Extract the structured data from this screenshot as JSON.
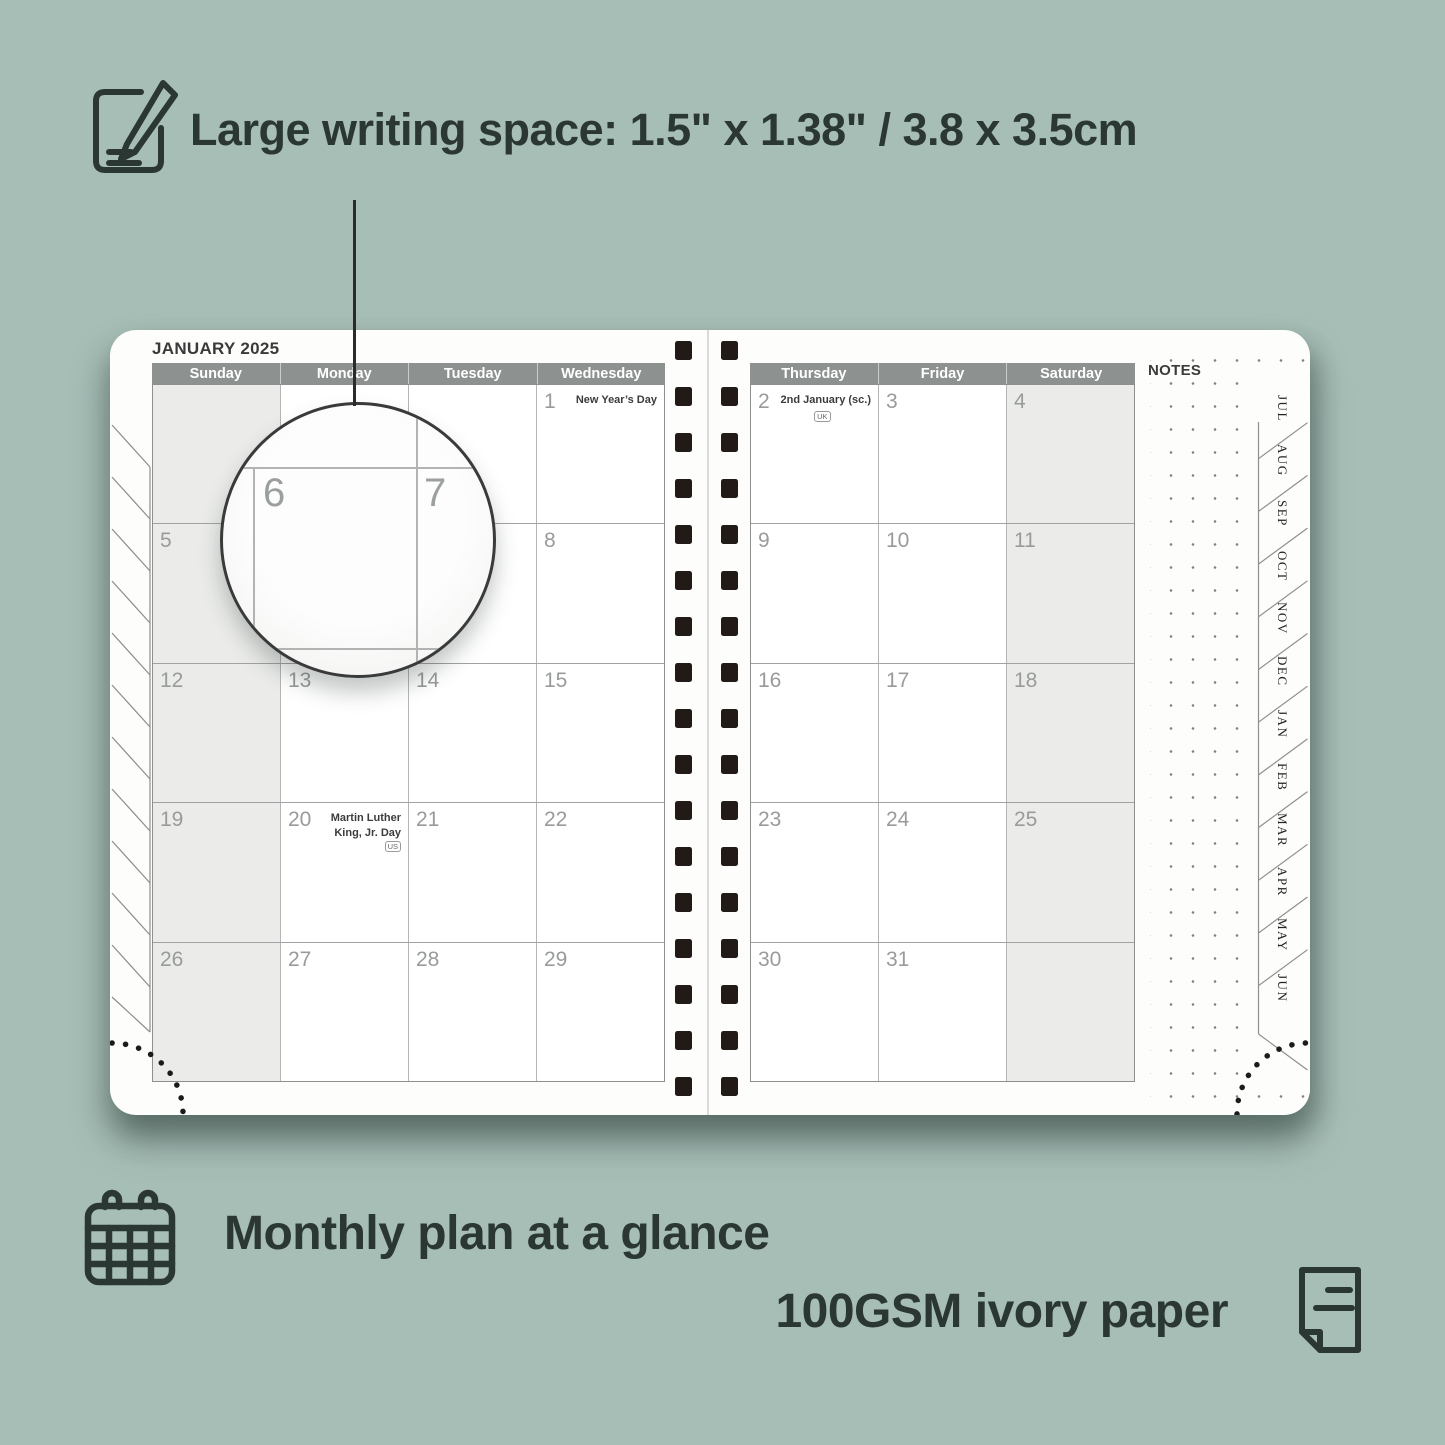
{
  "colors": {
    "background": "#a7beb7",
    "feature_text": "#2b3732",
    "day_header_bg": "#8d918f",
    "shaded_cell": "#ebecea",
    "spiral": "#221a17"
  },
  "features": {
    "writing_space": "Large writing space: 1.5\" x 1.38\" / 3.8 x 3.5cm",
    "monthly_plan": "Monthly plan at a glance",
    "paper": "100GSM ivory paper"
  },
  "planner": {
    "title": "JANUARY 2025",
    "notes_label": "NOTES",
    "left_day_headers": [
      "Sunday",
      "Monday",
      "Tuesday",
      "Wednesday"
    ],
    "right_day_headers": [
      "Thursday",
      "Friday",
      "Saturday"
    ],
    "month_tabs": [
      "JUL",
      "AUG",
      "SEP",
      "OCT",
      "NOV",
      "DEC",
      "JAN",
      "FEB",
      "MAR",
      "APR",
      "MAY",
      "JUN"
    ],
    "shaded_columns": {
      "left": [
        0
      ],
      "right": [
        2
      ]
    },
    "left_grid": [
      [
        {
          "date": ""
        },
        {
          "date": ""
        },
        {
          "date": ""
        },
        {
          "date": "1",
          "holiday": "New Year’s Day"
        }
      ],
      [
        {
          "date": "5"
        },
        {
          "date": "6"
        },
        {
          "date": "7"
        },
        {
          "date": "8"
        }
      ],
      [
        {
          "date": "12"
        },
        {
          "date": "13"
        },
        {
          "date": "14"
        },
        {
          "date": "15"
        }
      ],
      [
        {
          "date": "19"
        },
        {
          "date": "20",
          "holiday": "Martin Luther King, Jr. Day",
          "badge": "US",
          "badge_position": "inline"
        },
        {
          "date": "21"
        },
        {
          "date": "22"
        }
      ],
      [
        {
          "date": "26"
        },
        {
          "date": "27"
        },
        {
          "date": "28"
        },
        {
          "date": "29"
        }
      ]
    ],
    "right_grid": [
      [
        {
          "date": "2",
          "holiday": "2nd January (sc.)",
          "badge": "UK",
          "badge_position": "below"
        },
        {
          "date": "3"
        },
        {
          "date": "4"
        }
      ],
      [
        {
          "date": "9"
        },
        {
          "date": "10"
        },
        {
          "date": "11"
        }
      ],
      [
        {
          "date": "16"
        },
        {
          "date": "17"
        },
        {
          "date": "18"
        }
      ],
      [
        {
          "date": "23"
        },
        {
          "date": "24"
        },
        {
          "date": "25"
        }
      ],
      [
        {
          "date": "30"
        },
        {
          "date": "31"
        },
        {
          "date": ""
        }
      ]
    ],
    "magnifier": {
      "dates": [
        "6",
        "7"
      ]
    }
  }
}
